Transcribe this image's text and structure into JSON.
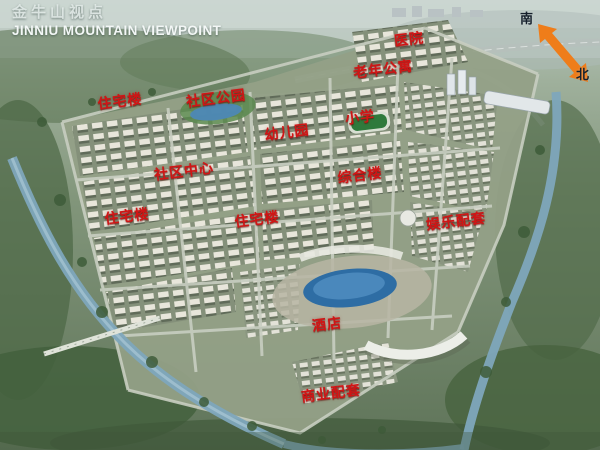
{
  "header": {
    "title_cn": "金牛山视点",
    "title_en": "JINNIU MOUNTAIN VIEWPOINT"
  },
  "compass": {
    "south_label": "南",
    "north_label": "北",
    "arrow_color": "#EF7D1A"
  },
  "map": {
    "label_color": "#D01515",
    "labels": [
      {
        "text": "医院",
        "x": 68.2,
        "y": 8.7
      },
      {
        "text": "老年公寓",
        "x": 63.8,
        "y": 15.3
      },
      {
        "text": "住宅楼",
        "x": 20.0,
        "y": 22.4
      },
      {
        "text": "社区公园",
        "x": 36.0,
        "y": 21.8
      },
      {
        "text": "幼儿园",
        "x": 47.8,
        "y": 29.3
      },
      {
        "text": "小学",
        "x": 60.0,
        "y": 26.0
      },
      {
        "text": "社区中心",
        "x": 30.7,
        "y": 38.0
      },
      {
        "text": "综合楼",
        "x": 60.0,
        "y": 38.9
      },
      {
        "text": "住宅楼",
        "x": 21.2,
        "y": 48.0
      },
      {
        "text": "住宅楼",
        "x": 42.8,
        "y": 48.7
      },
      {
        "text": "娱乐配套",
        "x": 76.0,
        "y": 49.1
      },
      {
        "text": "酒店",
        "x": 54.5,
        "y": 72.0
      },
      {
        "text": "商业配套",
        "x": 55.2,
        "y": 87.3
      }
    ]
  }
}
